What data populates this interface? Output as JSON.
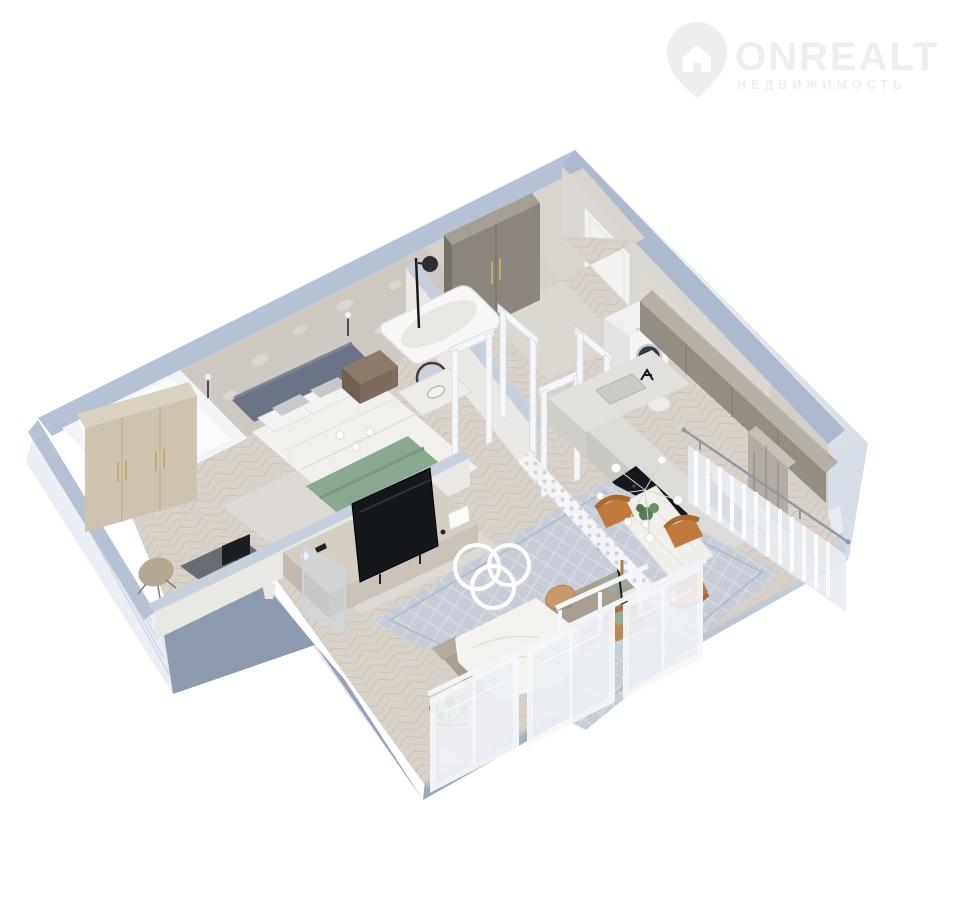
{
  "watermark": {
    "brand": "ONREALT",
    "tagline": "НЕДВИЖИМОСТЬ",
    "brand_color": "#f0efed",
    "tagline_color": "#edeff2",
    "icon": "house-pin-icon"
  },
  "scene": {
    "type": "3d-floorplan-render",
    "rooms": [
      "bedroom",
      "bathroom",
      "hallway",
      "kitchen",
      "dining-area",
      "living-room",
      "balcony"
    ],
    "furniture": [
      "wardrobe",
      "bed",
      "nightstand",
      "desk",
      "desk-chair",
      "bathtub",
      "shower",
      "round-mirror",
      "vanity",
      "washing-machine",
      "entry-door",
      "kitchen-counter",
      "sink",
      "cooktop",
      "oven-column",
      "wood-upper-cabinets",
      "dining-table",
      "dining-chairs",
      "chandelier",
      "floor-lamp",
      "tv-console",
      "tv",
      "ring-ceiling-lamp",
      "sofa",
      "blanket",
      "coffee-table",
      "plants",
      "lace-screen",
      "glass-partition",
      "windows"
    ],
    "palette": {
      "background": "#ffffff",
      "wall_top": "#b6c1d3",
      "wall_face_light": "#ebeef4",
      "slab_dark": "#8e9aad",
      "slab_mid": "#b9c3d2",
      "floor_beige": "#d8d2ca",
      "wallpaper": "#cfc9c3",
      "wardrobe_beige": "#cdc3b0",
      "cabinet_gray": "#8b857d",
      "wood_gray": "#938d83",
      "chair_orange": "#c0793d",
      "plant_green": "#5d7b57",
      "bed_throw_green": "#8ba990",
      "headboard_gray": "#6b7484",
      "sofa_taupe": "#a79d91",
      "appliance_dark": "#14171c",
      "glass_tint": "#eef1f5",
      "rug_blue_gray": "#c7cdd7",
      "brass": "#c7a96f"
    }
  }
}
